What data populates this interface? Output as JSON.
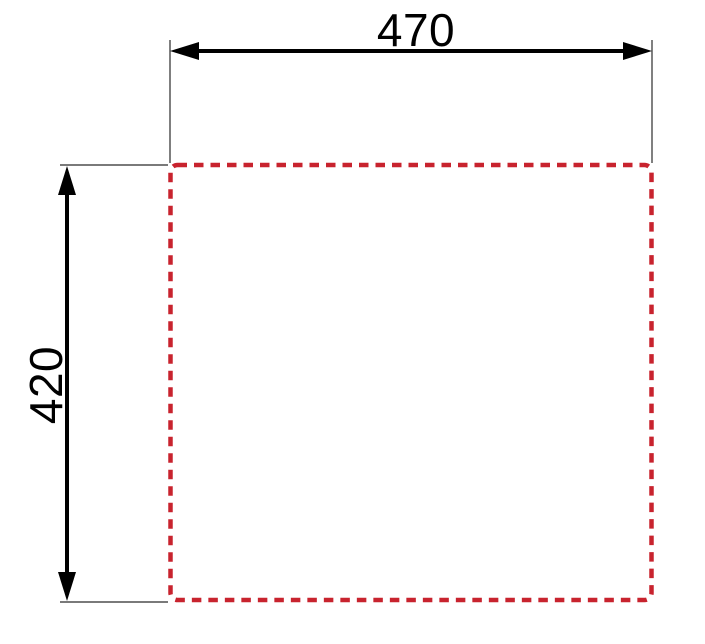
{
  "drawing": {
    "outline_color": "#c8232e",
    "dimension_color": "#000000",
    "extension_color": "#2a2a2a",
    "width_dimension": {
      "label": "470"
    },
    "height_dimension": {
      "label": "420"
    }
  }
}
